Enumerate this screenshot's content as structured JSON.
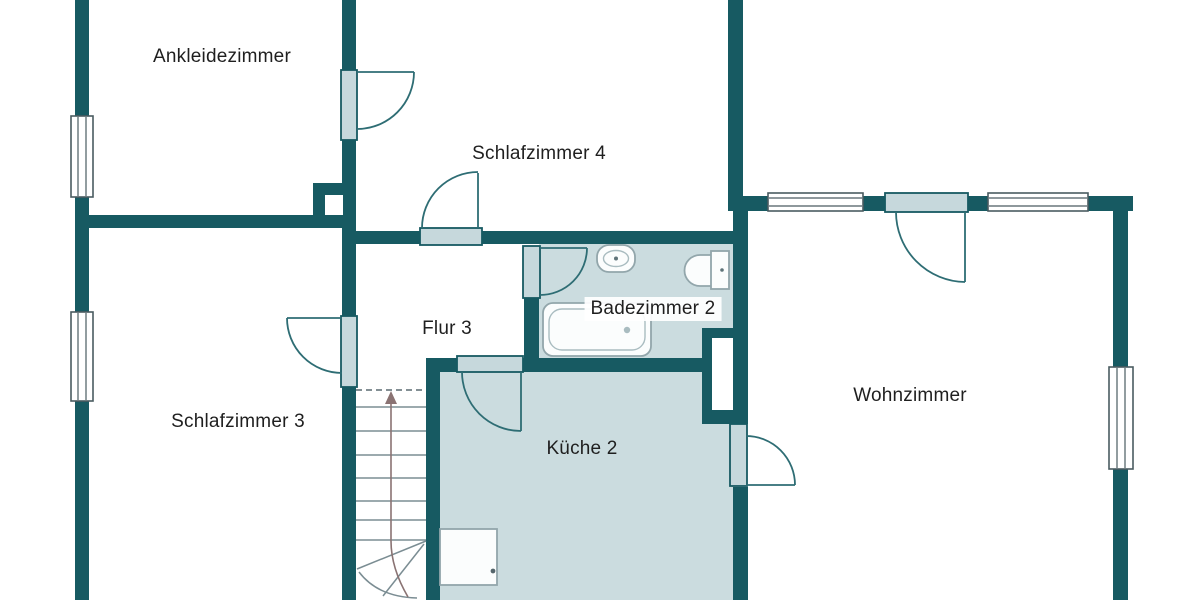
{
  "plan": {
    "title": "Obergeschoss Grundriss",
    "rooms": {
      "ankleidezimmer": {
        "label": "Ankleidezimmer"
      },
      "schlafzimmer4": {
        "label": "Schlafzimmer 4"
      },
      "badezimmer2": {
        "label": "Badezimmer 2"
      },
      "flur3": {
        "label": "Flur 3"
      },
      "schlafzimmer3": {
        "label": "Schlafzimmer 3"
      },
      "kueche2": {
        "label": "Küche 2"
      },
      "wohnzimmer": {
        "label": "Wohnzimmer"
      }
    },
    "fixtures": {
      "bathtub": "bathtub-icon",
      "sink": "sink-icon",
      "toilet": "toilet-icon",
      "appliance": "appliance-icon",
      "stairs": "stairs-icon",
      "shaft": "shaft-icon"
    },
    "colors": {
      "wall": "#175a62",
      "floor_tinted": "#cbdcdf",
      "floor_white": "#ffffff",
      "door_panel": "#c6d8dc",
      "door_line": "#2e6d74",
      "window_line": "#4a5b60",
      "fixture_line": "#92a6ab",
      "stair_line": "#7b8d93",
      "text": "#1f1f1f"
    }
  }
}
